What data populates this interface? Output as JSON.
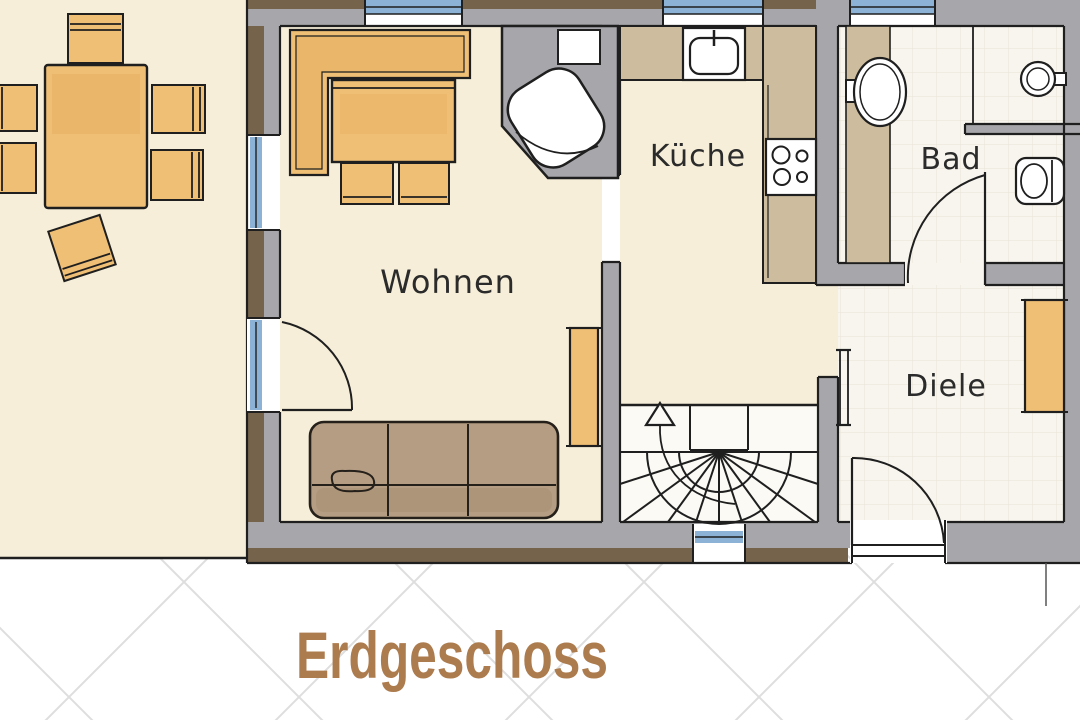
{
  "title": {
    "label": "Erdgeschoss"
  },
  "rooms": {
    "wohnen": {
      "label": "Wohnen"
    },
    "kueche": {
      "label": "Küche"
    },
    "bad": {
      "label": "Bad"
    },
    "diele": {
      "label": "Diele"
    }
  },
  "colors": {
    "title_text": "#ad7c4e",
    "label_text": "#2b2b2b",
    "floor_cream": "#f6eed8",
    "floor_tile": "#f7f5ed",
    "wall_gray": "#a7a7ab",
    "wall_brown": "#76634b",
    "wood_orange": "#efbf76",
    "counter_tan": "#cdbd9e",
    "sofa_brown": "#b49d83",
    "window_blue": "#8cb3d6",
    "ink": "#1f1f1f"
  },
  "furniture_icons": [
    "dining-table",
    "dining-chair",
    "corner-bench",
    "table",
    "sofa",
    "sideboard",
    "wardrobe",
    "corner-fireplace",
    "kitchen-sink",
    "stove",
    "washbasin",
    "wc-sink",
    "toilet",
    "winder-stairs",
    "stairs-up-arrow"
  ]
}
